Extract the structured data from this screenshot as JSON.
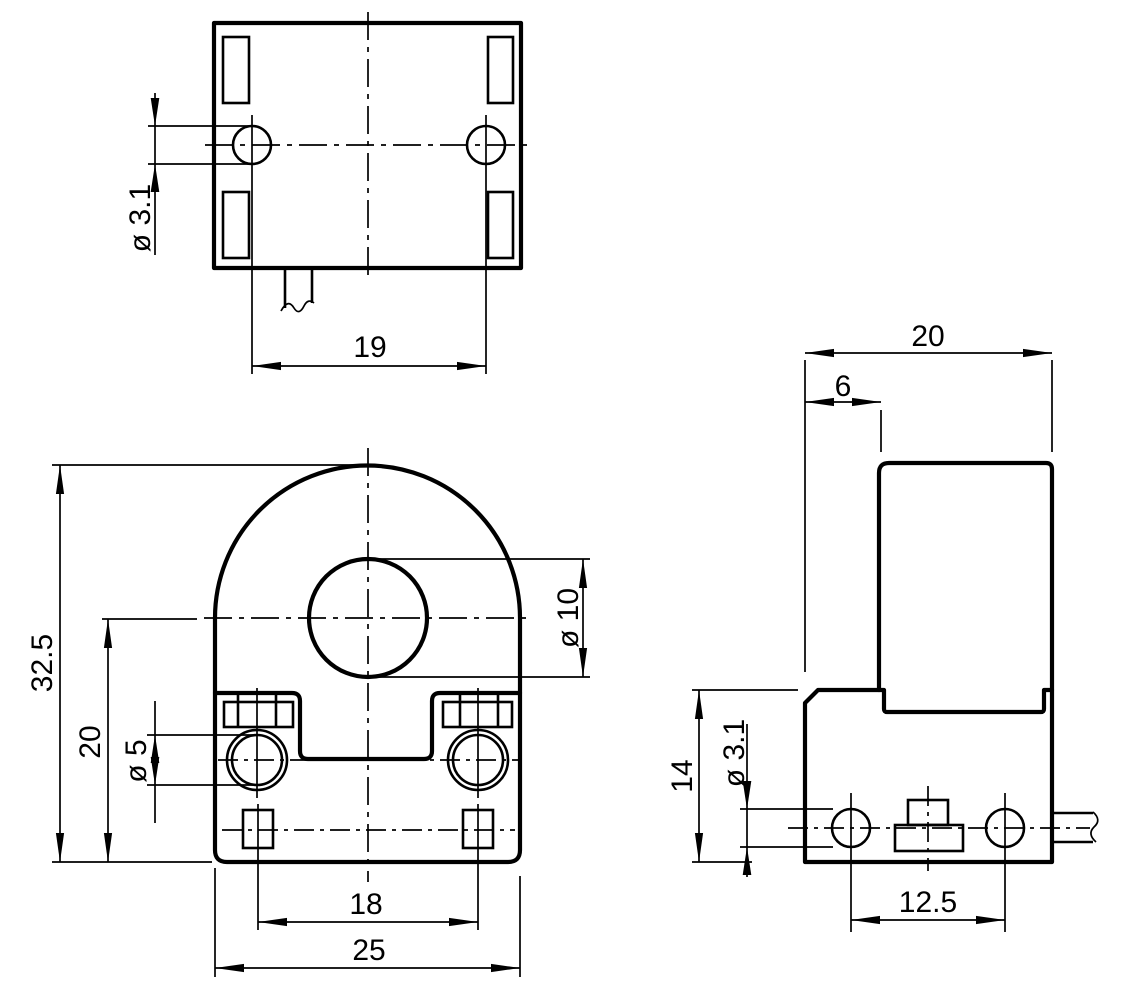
{
  "dims": {
    "top": {
      "hole_dia": "ø 3.1",
      "hole_pitch": "19"
    },
    "front": {
      "height": "32.5",
      "center_height": "20",
      "screw_dia": "ø 5",
      "pin_pitch": "18",
      "width": "25",
      "bore_dia": "ø 10"
    },
    "side": {
      "depth": "20",
      "offset": "6",
      "base_height": "14",
      "hole_dia": "ø 3.1",
      "hole_pitch": "12.5"
    }
  },
  "colors": {
    "line": "#000000",
    "background": "#ffffff"
  }
}
